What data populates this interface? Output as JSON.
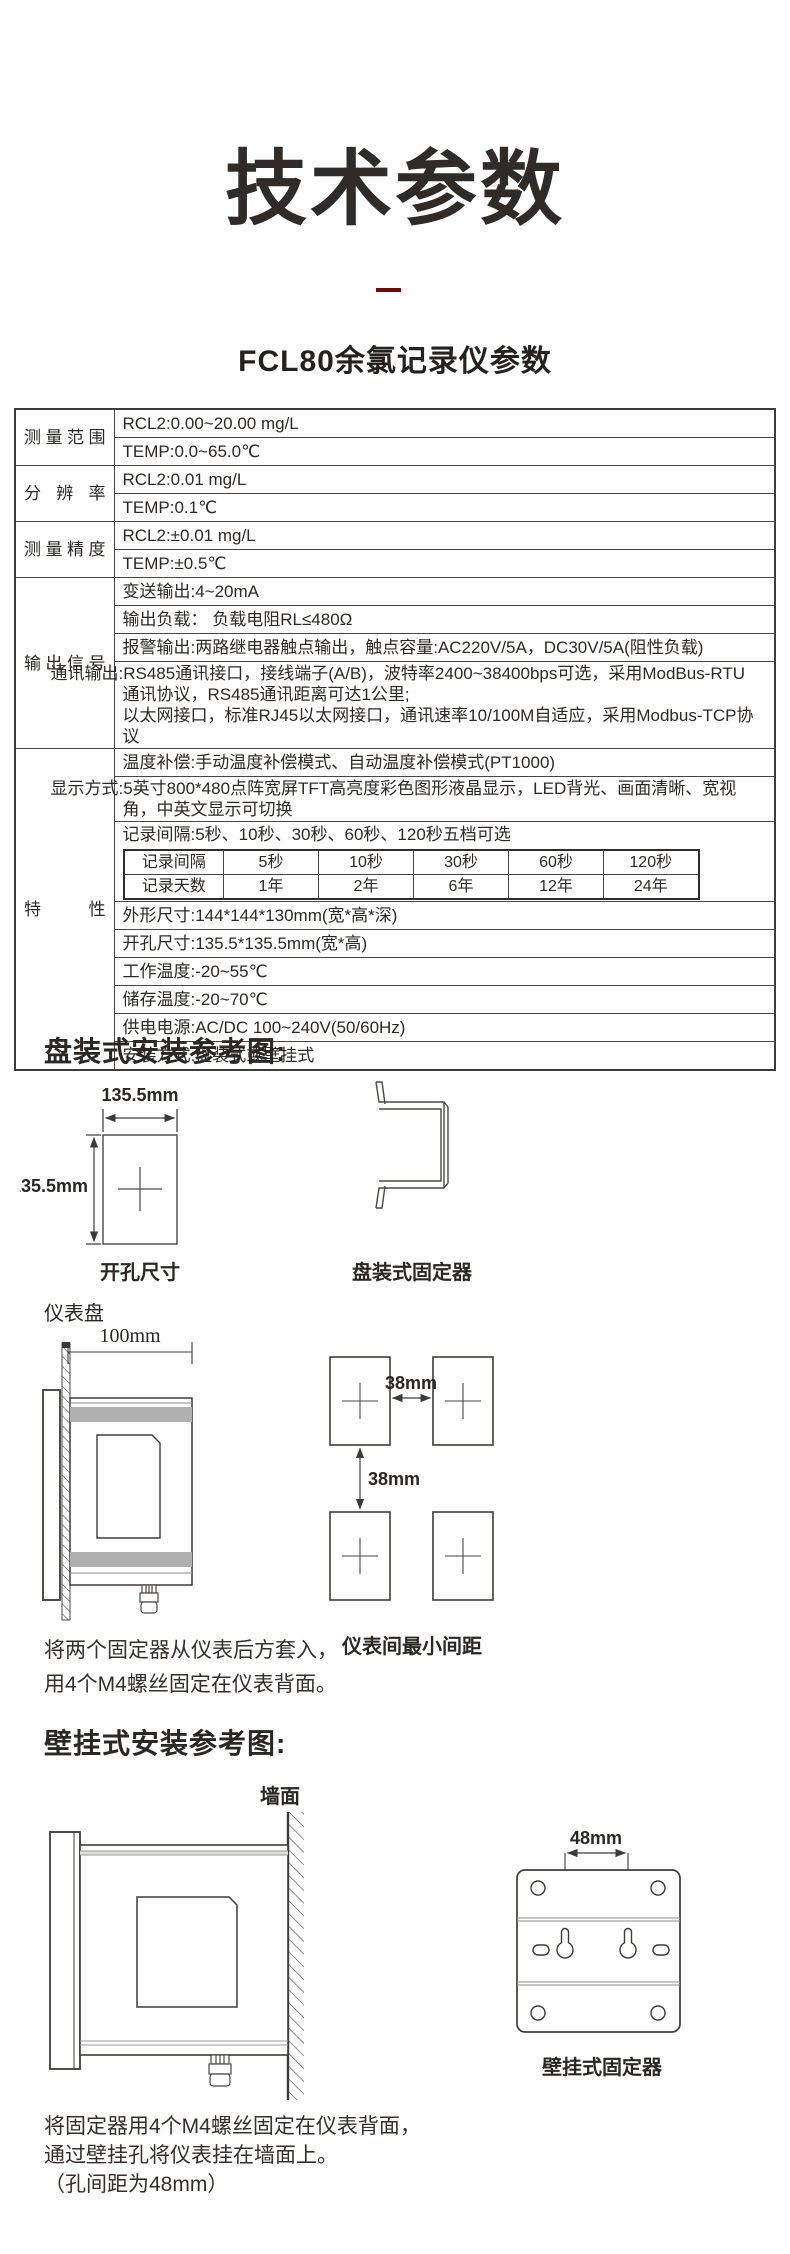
{
  "header": {
    "title": "技术参数",
    "subtitle": "FCL80余氯记录仪参数",
    "accent_color": "#6b0b0b"
  },
  "spec_table": {
    "groups": [
      {
        "label": "测量范围",
        "rows": [
          "RCL2:0.00~20.00 mg/L",
          "TEMP:0.0~65.0℃"
        ]
      },
      {
        "label": "分辨率",
        "rows": [
          "RCL2:0.01 mg/L",
          "TEMP:0.1℃"
        ]
      },
      {
        "label": "测量精度",
        "rows": [
          "RCL2:±0.01 mg/L",
          "TEMP:±0.5℃"
        ]
      },
      {
        "label": "输出信号",
        "rows": [
          "变送输出:4~20mA",
          "输出负载： 负载电阻RL≤480Ω",
          "报警输出:两路继电器触点输出，触点容量:AC220V/5A，DC30V/5A(阻性负载)",
          "通讯输出:RS485通讯接口，接线端子(A/B)，波特率2400~38400bps可选，采用ModBus-RTU\n通讯协议，RS485通讯距离可达1公里;\n以太网接口，标准RJ45以太网接口，通讯速率10/100M自适应，采用Modbus-TCP协议"
        ]
      },
      {
        "label": "特性",
        "rows": [
          "温度补偿:手动温度补偿模式、自动温度补偿模式(PT1000)",
          "显示方式:5英寸800*480点阵宽屏TFT高亮度彩色图形液晶显示，LED背光、画面清晰、宽视\n角，中英文显示可切换",
          "记录间隔:5秒、10秒、30秒、60秒、120秒五档可选",
          "外形尺寸:144*144*130mm(宽*高*深)",
          "开孔尺寸:135.5*135.5mm(宽*高)",
          "工作温度:-20~55℃",
          "储存温度:-20~70℃",
          "供电电源:AC/DC 100~240V(50/60Hz)",
          "安装方式:盘装式或壁挂式"
        ]
      }
    ],
    "record_table": {
      "rows": [
        [
          "记录间隔",
          "5秒",
          "10秒",
          "30秒",
          "60秒",
          "120秒"
        ],
        [
          "记录天数",
          "1年",
          "2年",
          "6年",
          "12年",
          "24年"
        ]
      ]
    }
  },
  "panel_install": {
    "heading": "盘装式安装参考图:",
    "cutout_width_dim": "135.5mm",
    "cutout_height_dim": "135.5mm",
    "cutout_label": "开孔尺寸",
    "bracket_label": "盘装式固定器",
    "panel_label": "仪表盘",
    "depth_dim": "100mm",
    "spacing_h_dim": "38mm",
    "spacing_v_dim": "38mm",
    "spacing_label": "仪表间最小间距",
    "caption_line1": "将两个固定器从仪表后方套入，",
    "caption_line2": "用4个M4螺丝固定在仪表背面。"
  },
  "wall_install": {
    "heading": "壁挂式安装参考图:",
    "wall_label": "墙面",
    "hole_dim": "48mm",
    "plate_label": "壁挂式固定器",
    "caption_line1": "将固定器用4个M4螺丝固定在仪表背面，",
    "caption_line2": "通过壁挂孔将仪表挂在墙面上。",
    "caption_line3": "（孔间距为48mm）"
  }
}
